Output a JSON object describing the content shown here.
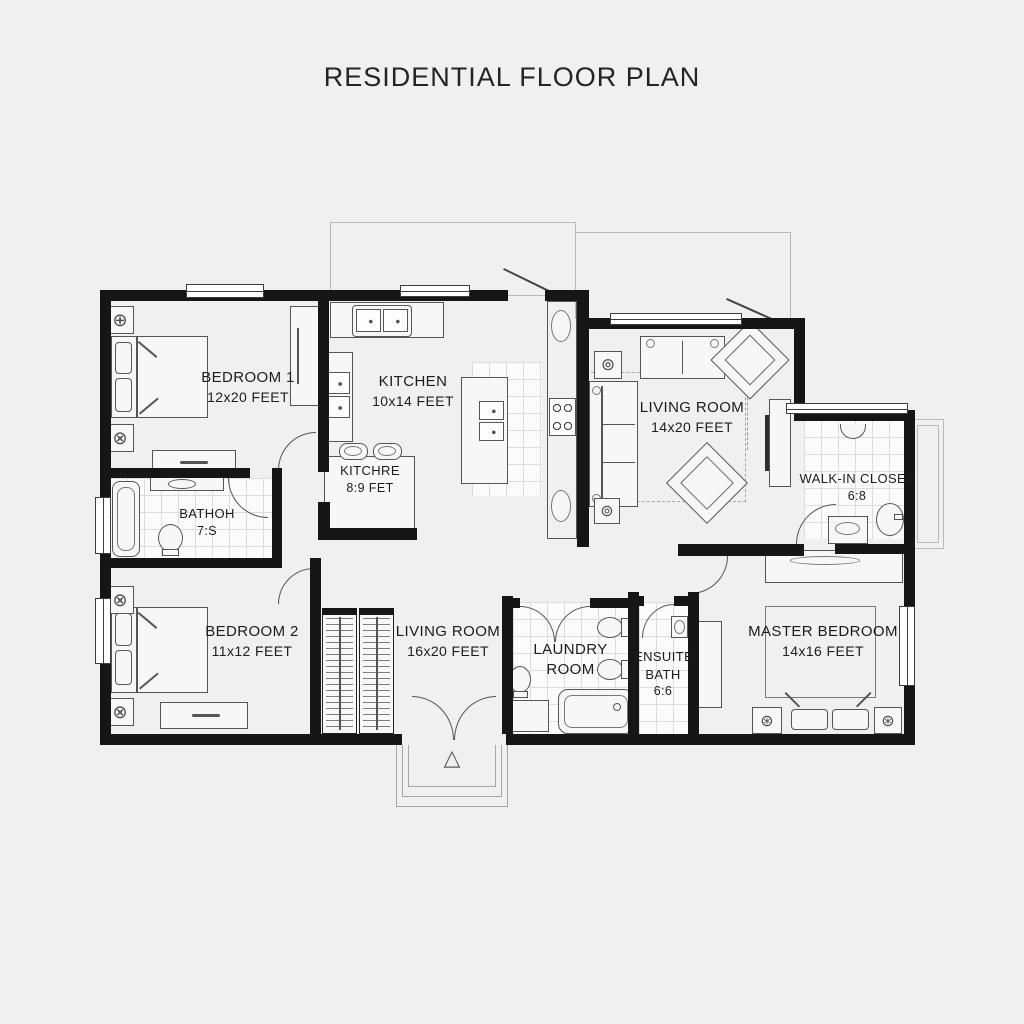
{
  "title": "RESIDENTIAL FLOOR PLAN",
  "rooms": {
    "bedroom1": {
      "name": "BEDROOM 1",
      "size": "12x20 FEET"
    },
    "kitchen": {
      "name": "KITCHEN",
      "size": "10x14 FEET"
    },
    "kitchen_nook": {
      "name": "KITCHRE",
      "size": "8:9 FET"
    },
    "living_upper": {
      "name": "LIVING ROOM",
      "size": "14x20 FEET"
    },
    "walk_in_closet": {
      "name": "WALK-IN CLOSET",
      "size": "6:8"
    },
    "bathroom": {
      "name": "BATHOH",
      "size": "7:S"
    },
    "bedroom2": {
      "name": "BEDROOM 2",
      "size": "11x12 FEET"
    },
    "living_lower": {
      "name": "LIVING ROOM",
      "size": "16x20 FEET"
    },
    "laundry": {
      "line1": "LAUNDRY",
      "line2": "ROOM"
    },
    "ensuite": {
      "line1": "ENSUITE",
      "line2": "BATH",
      "line3": "6:6"
    },
    "master": {
      "name": "MASTER BEDROOM",
      "size": "14x16 FEET"
    }
  },
  "icons": {
    "ceiling_fixture_cross": "⊕",
    "ceiling_fixture_fan": "⊗",
    "floor_lamp": "⊚",
    "table_lamp": "⊛",
    "entry_arrow": "△"
  },
  "colors": {
    "wall": "#161616",
    "background": "#f0f0f1",
    "furniture_line": "#555555",
    "tile_line": "#dcdcdc"
  }
}
